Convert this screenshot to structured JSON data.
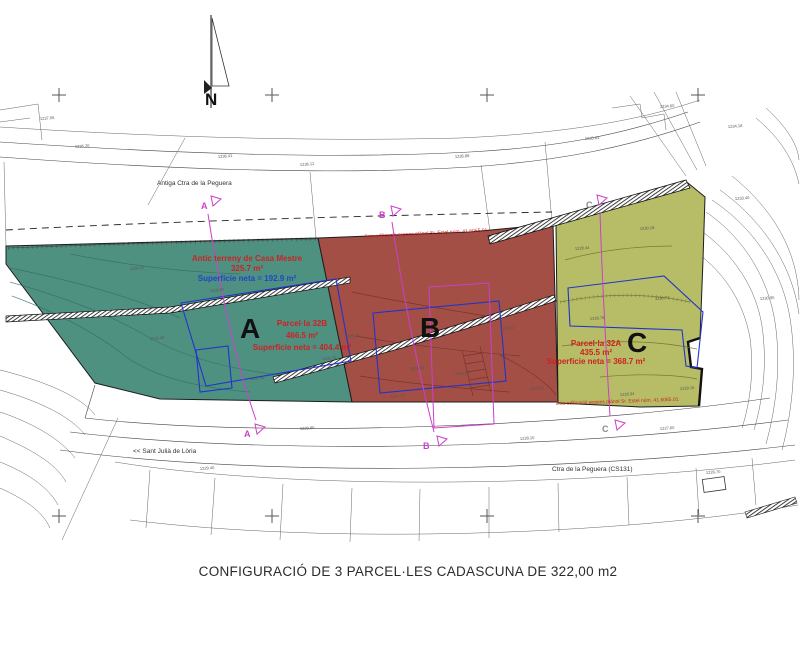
{
  "caption": "CONFIGURACIÓ DE 3 PARCEL·LES CADASCUNA DE 322,00 m2",
  "compass": {
    "label": "N"
  },
  "roads": {
    "old_road": "Antiga Ctra de la Peguera",
    "direction": "<< Sant Julià de Lòria",
    "main_road": "Ctra de la Peguera (CS131)"
  },
  "parcels": {
    "a": {
      "letter": "A",
      "lot": "Parcel·la 32B",
      "area": "466.5 m²",
      "net": "Superficie neta = 404.4 m²"
    },
    "a_old": {
      "name": "Antic terreny de Casa Mestre",
      "area": "325.7 m²",
      "net": "Superficie neta = 192.9 m²"
    },
    "b": {
      "letter": "B"
    },
    "c": {
      "letter": "C",
      "lot": "Parcel·la 32A",
      "area": "435.5 m²",
      "net": "Superficie neta = 368.7 m²"
    }
  },
  "section_markers": {
    "a": "A",
    "b": "B",
    "c": "C"
  },
  "notes": {
    "top": "línia edificació segons plànol Sr. Estel núm. 41.6065.01",
    "bottom": "línia edificació segons plànol Sr. Estel núm. 41.6065.01"
  },
  "colors": {
    "parcel_a_fill": "#4f9181",
    "parcel_b_fill": "#a34f46",
    "parcel_c_fill": "#b6bd66",
    "building_outline": "#2233cc",
    "section_line": "#cc3fcc",
    "label_red": "#cc2222",
    "label_blue": "#2244cc"
  },
  "crosshairs": [
    [
      59,
      95
    ],
    [
      272,
      95
    ],
    [
      487,
      95
    ],
    [
      698,
      95
    ],
    [
      59,
      516
    ],
    [
      272,
      516
    ],
    [
      487,
      516
    ],
    [
      698,
      516
    ]
  ],
  "spot_elevations": [
    {
      "x": 75,
      "y": 148,
      "v": "1236.20"
    },
    {
      "x": 218,
      "y": 158,
      "v": "1236.41"
    },
    {
      "x": 300,
      "y": 166,
      "v": "1236.12"
    },
    {
      "x": 455,
      "y": 158,
      "v": "1235.88"
    },
    {
      "x": 585,
      "y": 140,
      "v": "1235.64"
    },
    {
      "x": 40,
      "y": 120,
      "v": "1237.05"
    },
    {
      "x": 660,
      "y": 108,
      "v": "1234.60"
    },
    {
      "x": 728,
      "y": 128,
      "v": "1234.18"
    },
    {
      "x": 130,
      "y": 270,
      "v": "1234.52"
    },
    {
      "x": 210,
      "y": 292,
      "v": "1233.87"
    },
    {
      "x": 150,
      "y": 340,
      "v": "1232.40"
    },
    {
      "x": 250,
      "y": 380,
      "v": "1231.95"
    },
    {
      "x": 322,
      "y": 360,
      "v": "1232.10"
    },
    {
      "x": 345,
      "y": 338,
      "v": "1228.36"
    },
    {
      "x": 410,
      "y": 370,
      "v": "1231.42"
    },
    {
      "x": 455,
      "y": 375,
      "v": "1231.66"
    },
    {
      "x": 390,
      "y": 398,
      "v": "1224.74"
    },
    {
      "x": 500,
      "y": 330,
      "v": "1228.52"
    },
    {
      "x": 530,
      "y": 390,
      "v": "1228.22"
    },
    {
      "x": 590,
      "y": 320,
      "v": "1228.76"
    },
    {
      "x": 655,
      "y": 300,
      "v": "1230.74"
    },
    {
      "x": 620,
      "y": 396,
      "v": "1228.34"
    },
    {
      "x": 680,
      "y": 390,
      "v": "1229.16"
    },
    {
      "x": 575,
      "y": 250,
      "v": "1229.44"
    },
    {
      "x": 640,
      "y": 230,
      "v": "1230.18"
    },
    {
      "x": 735,
      "y": 200,
      "v": "1233.40"
    },
    {
      "x": 760,
      "y": 300,
      "v": "1230.90"
    },
    {
      "x": 300,
      "y": 430,
      "v": "1228.80"
    },
    {
      "x": 520,
      "y": 440,
      "v": "1228.10"
    },
    {
      "x": 660,
      "y": 430,
      "v": "1227.60"
    },
    {
      "x": 200,
      "y": 470,
      "v": "1229.40"
    },
    {
      "x": 706,
      "y": 474,
      "v": "1228.70"
    }
  ]
}
